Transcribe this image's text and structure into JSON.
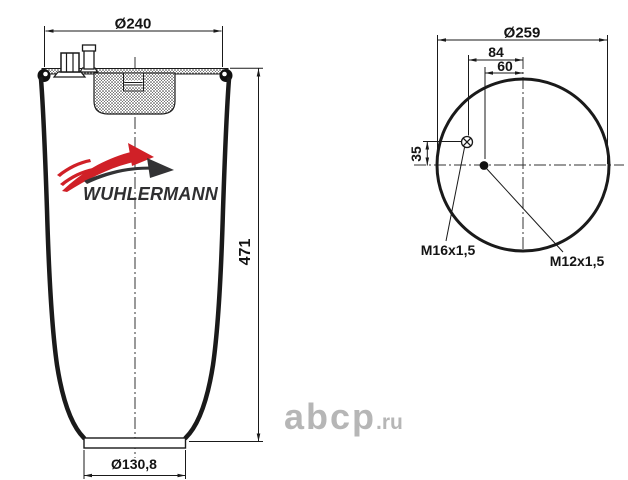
{
  "drawing": {
    "side_view": {
      "top_diameter": "Ø240",
      "height": "471",
      "bottom_diameter": "Ø130,8"
    },
    "top_view": {
      "outer_diameter": "Ø259",
      "fitting_offset_x": "84",
      "stud_offset_x": "60",
      "fitting_offset_y": "35",
      "air_fitting_thread": "M16x1,5",
      "stud_thread": "M12x1,5"
    }
  },
  "brand": {
    "name": "WUHLERMANN"
  },
  "watermark": {
    "main": "abcp",
    "suffix": ".ru"
  },
  "colors": {
    "line": "#1a1a1a",
    "brand_red": "#d02027",
    "brand_dark": "#333335",
    "watermark_gray": "#b6b6b6",
    "background": "#ffffff"
  }
}
